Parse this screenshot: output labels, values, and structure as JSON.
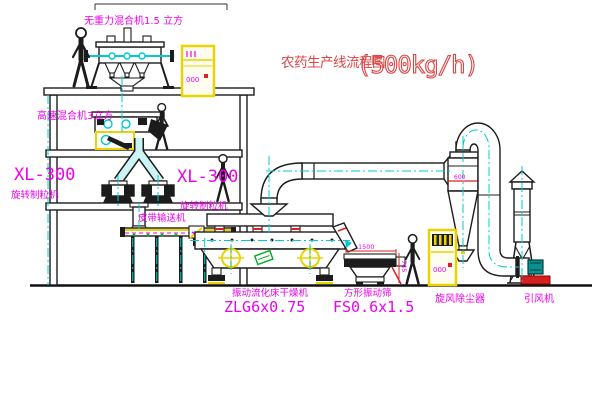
{
  "title": {
    "name_zh": "农药生产线流程图",
    "capacity": "(500kg/h)"
  },
  "labels": {
    "gravity_mixer": "无重力混合机1.5 立方",
    "high_speed_mixer": "高速混合机3立方",
    "granulator_model_left": "XL-300",
    "granulator_name_left": "旋转制粒机",
    "granulator_model_center": "XL-300",
    "granulator_name_center": "旋转制粒机",
    "belt_conveyor": "皮带输送机",
    "dryer_name": "振动流化床干燥机",
    "dryer_model": "ZLG6x0.75",
    "sieve_name": "方形振动筛",
    "sieve_model": "FS0.6x1.5",
    "cyclone_name": "旋风除尘器",
    "fan_name": "引风机",
    "dim_sieve_length": "1500",
    "dim_sieve_height": "745",
    "dim_cyclone": "600",
    "cabinet_display": "000"
  },
  "colors": {
    "line": "#1c1c1c",
    "centerline_cyan": "#00cccc",
    "label_magenta": "#ee00ee",
    "title_red": "#dd4444",
    "cabinet_yellow": "#e8d400",
    "detail_red": "#dd2020",
    "detail_green": "#00aa22",
    "pipe_fill": "#cdf4f4"
  }
}
